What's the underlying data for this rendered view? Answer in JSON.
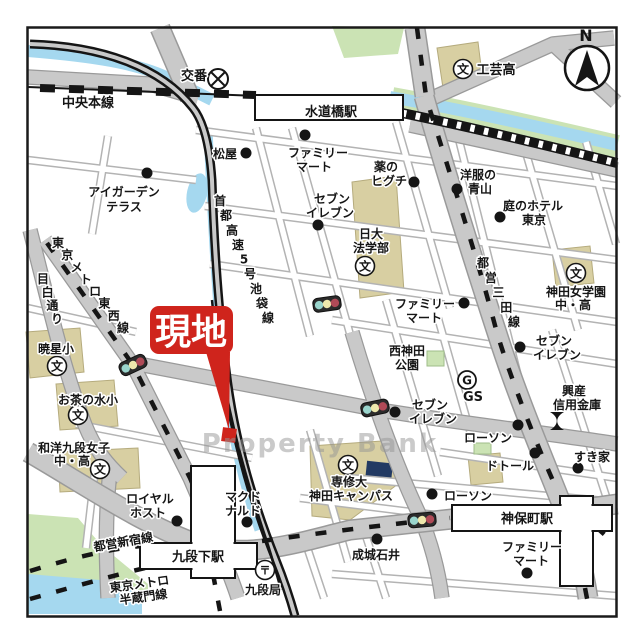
{
  "colors": {
    "site_red": "#cf241c",
    "river_blue": "#a5d8ef",
    "park_green": "#cbe3b4",
    "building_tan": "#d8cfa2",
    "road_gray": "#c9c9c9",
    "rail_black": "#151515",
    "navy_building": "#223a63",
    "watermark_gray": "#969696"
  },
  "map": {
    "compass": {
      "label": "N"
    },
    "watermark": {
      "text": "Property Bank"
    },
    "site_callout": {
      "text": "現地"
    },
    "stations": [
      {
        "name": "suidobashi-station",
        "label": "水道橋駅",
        "rects": [
          [
            255,
            95,
            148,
            25
          ]
        ],
        "label_xy": [
          331,
          116
        ]
      },
      {
        "name": "kudanshita-station",
        "label": "九段下駅",
        "rects": [
          [
            191,
            466,
            44,
            112
          ],
          [
            140,
            543,
            117,
            26
          ]
        ],
        "label_xy": [
          198,
          561
        ]
      },
      {
        "name": "jimbocho-station",
        "label": "神保町駅",
        "rects": [
          [
            560,
            496,
            33,
            90
          ],
          [
            452,
            505,
            160,
            26
          ]
        ],
        "label_xy": [
          527,
          523
        ]
      }
    ],
    "labels": [
      {
        "name": "koban-label",
        "t": "交番",
        "x": 194,
        "y": 80,
        "s": 13
      },
      {
        "name": "chuo-main-line-label",
        "t": "中央本線",
        "x": 88,
        "y": 107,
        "s": 13
      },
      {
        "name": "kogei-high-label",
        "t": "工芸高",
        "x": 496,
        "y": 74,
        "s": 13
      },
      {
        "name": "matsuya-label",
        "t": "松屋",
        "x": 225,
        "y": 158
      },
      {
        "name": "familymart-north-1",
        "t": "ファミリー",
        "x": 318,
        "y": 157
      },
      {
        "name": "familymart-north-2",
        "t": "マート",
        "x": 314,
        "y": 171
      },
      {
        "name": "kusuri-higuchi-1",
        "t": "薬の",
        "x": 386,
        "y": 171
      },
      {
        "name": "kusuri-higuchi-2",
        "t": "ヒグチ",
        "x": 389,
        "y": 185
      },
      {
        "name": "aoyama-suits-1",
        "t": "洋服の",
        "x": 478,
        "y": 179
      },
      {
        "name": "aoyama-suits-2",
        "t": "青山",
        "x": 480,
        "y": 193
      },
      {
        "name": "niwa-hotel-1",
        "t": "庭のホテル",
        "x": 533,
        "y": 210
      },
      {
        "name": "niwa-hotel-2",
        "t": "東京",
        "x": 534,
        "y": 224
      },
      {
        "name": "seven-eleven-nw-1",
        "t": "セブン",
        "x": 332,
        "y": 203
      },
      {
        "name": "seven-eleven-nw-2",
        "t": "イレブン",
        "x": 330,
        "y": 217
      },
      {
        "name": "nichidai-law-1",
        "t": "日大",
        "x": 371,
        "y": 238
      },
      {
        "name": "nichidai-law-2",
        "t": "法学部",
        "x": 371,
        "y": 252
      },
      {
        "name": "kanda-jogakuen-1",
        "t": "神田女学園",
        "x": 576,
        "y": 296
      },
      {
        "name": "kanda-jogakuen-2",
        "t": "中・高",
        "x": 573,
        "y": 309
      },
      {
        "name": "igarden-terrace-1",
        "t": "アイガーデン",
        "x": 124,
        "y": 196
      },
      {
        "name": "igarden-terrace-2",
        "t": "テラス",
        "x": 124,
        "y": 211
      },
      {
        "name": "familymart-mid-1",
        "t": "ファミリー",
        "x": 425,
        "y": 308
      },
      {
        "name": "familymart-mid-2",
        "t": "マート",
        "x": 424,
        "y": 322
      },
      {
        "name": "nishikanda-park-1",
        "t": "西神田",
        "x": 407,
        "y": 355
      },
      {
        "name": "nishikanda-park-2",
        "t": "公園",
        "x": 407,
        "y": 369
      },
      {
        "name": "gs-label",
        "t": "GS",
        "x": 473,
        "y": 401,
        "s": 13
      },
      {
        "name": "seven-eleven-e-1",
        "t": "セブン",
        "x": 554,
        "y": 345
      },
      {
        "name": "seven-eleven-e-2",
        "t": "イレブン",
        "x": 557,
        "y": 359
      },
      {
        "name": "kosan-shinkin-1",
        "t": "興産",
        "x": 574,
        "y": 395
      },
      {
        "name": "kosan-shinkin-2",
        "t": "信用金庫",
        "x": 577,
        "y": 409
      },
      {
        "name": "seven-eleven-c-1",
        "t": "セブン",
        "x": 430,
        "y": 409
      },
      {
        "name": "seven-eleven-c-2",
        "t": "イレブン",
        "x": 433,
        "y": 423
      },
      {
        "name": "lawson-c-label",
        "t": "ローソン",
        "x": 488,
        "y": 442
      },
      {
        "name": "doutor-label",
        "t": "ドトール",
        "x": 510,
        "y": 470
      },
      {
        "name": "sukiya-label",
        "t": "すき家",
        "x": 592,
        "y": 461
      },
      {
        "name": "lawson-s-label",
        "t": "ローソン",
        "x": 468,
        "y": 500
      },
      {
        "name": "senshu-univ-1",
        "t": "専修大",
        "x": 349,
        "y": 486
      },
      {
        "name": "senshu-univ-2",
        "t": "神田キャンパス",
        "x": 351,
        "y": 500
      },
      {
        "name": "royal-host-1",
        "t": "ロイヤル",
        "x": 150,
        "y": 503
      },
      {
        "name": "royal-host-2",
        "t": "ホスト",
        "x": 148,
        "y": 517
      },
      {
        "name": "mcdonalds-1",
        "t": "マクド",
        "x": 243,
        "y": 501
      },
      {
        "name": "mcdonalds-2",
        "t": "ナルド",
        "x": 243,
        "y": 515
      },
      {
        "name": "toei-shinjuku-line-label",
        "t": "都営新宿線",
        "x": 124,
        "y": 546,
        "r": -10
      },
      {
        "name": "kudan-post-label",
        "t": "九段局",
        "x": 263,
        "y": 594
      },
      {
        "name": "hanzomon-line-1",
        "t": "東京メトロ",
        "x": 140,
        "y": 588,
        "r": -8
      },
      {
        "name": "hanzomon-line-2",
        "t": "半蔵門線",
        "x": 144,
        "y": 601,
        "r": -8
      },
      {
        "name": "seijo-ishii-label",
        "t": "成城石井",
        "x": 376,
        "y": 559
      },
      {
        "name": "familymart-se-1",
        "t": "ファミリー",
        "x": 532,
        "y": 551
      },
      {
        "name": "familymart-se-2",
        "t": "マート",
        "x": 531,
        "y": 565
      },
      {
        "name": "gyosei-elem-label",
        "t": "暁星小",
        "x": 56,
        "y": 353
      },
      {
        "name": "ochanomizu-elem-label",
        "t": "お茶の水小",
        "x": 88,
        "y": 404
      },
      {
        "name": "wayo-kudan-1",
        "t": "和洋九段女子",
        "x": 74,
        "y": 452
      },
      {
        "name": "wayo-kudan-2",
        "t": "中・高",
        "x": 72,
        "y": 465
      }
    ],
    "path_labels": [
      {
        "name": "shuto-expressway-label",
        "t": "首都高速5号池袋線",
        "x1": 220,
        "y1": 205,
        "x2": 268,
        "y2": 322
      },
      {
        "name": "tozai-line-label",
        "t": "東京メトロ東西線",
        "x1": 58,
        "y1": 247,
        "x2": 123,
        "y2": 332
      },
      {
        "name": "mejiro-dori-label",
        "t": "目白通り",
        "x1": 43,
        "y1": 283,
        "x2": 57,
        "y2": 323
      },
      {
        "name": "mita-line-label",
        "t": "都営三田線",
        "x1": 483,
        "y1": 267,
        "x2": 514,
        "y2": 326
      }
    ],
    "markers": {
      "dots": [
        [
          246,
          153
        ],
        [
          305,
          135
        ],
        [
          414,
          182
        ],
        [
          457,
          189
        ],
        [
          500,
          217
        ],
        [
          318,
          225
        ],
        [
          147,
          173
        ],
        [
          464,
          303
        ],
        [
          520,
          347
        ],
        [
          395,
          412
        ],
        [
          518,
          425
        ],
        [
          535,
          453
        ],
        [
          578,
          468
        ],
        [
          432,
          494
        ],
        [
          177,
          521
        ],
        [
          247,
          522
        ],
        [
          377,
          539
        ],
        [
          527,
          573
        ]
      ],
      "schools": [
        [
          463,
          69
        ],
        [
          365,
          266
        ],
        [
          576,
          273
        ],
        [
          57,
          366
        ],
        [
          78,
          415
        ],
        [
          100,
          469
        ],
        [
          348,
          465
        ]
      ],
      "school_glyph": "文",
      "traffic_lights": [
        [
          327,
          304,
          -8
        ],
        [
          133,
          365,
          -25
        ],
        [
          375,
          408,
          -12
        ],
        [
          422,
          520,
          -5
        ]
      ],
      "koban": {
        "x": 218,
        "y": 79
      },
      "gs": {
        "x": 467,
        "y": 380,
        "glyph": "G"
      },
      "post_office": {
        "x": 265,
        "y": 570,
        "glyph": "〒"
      },
      "bank": {
        "x": 557,
        "y": 421
      }
    }
  }
}
